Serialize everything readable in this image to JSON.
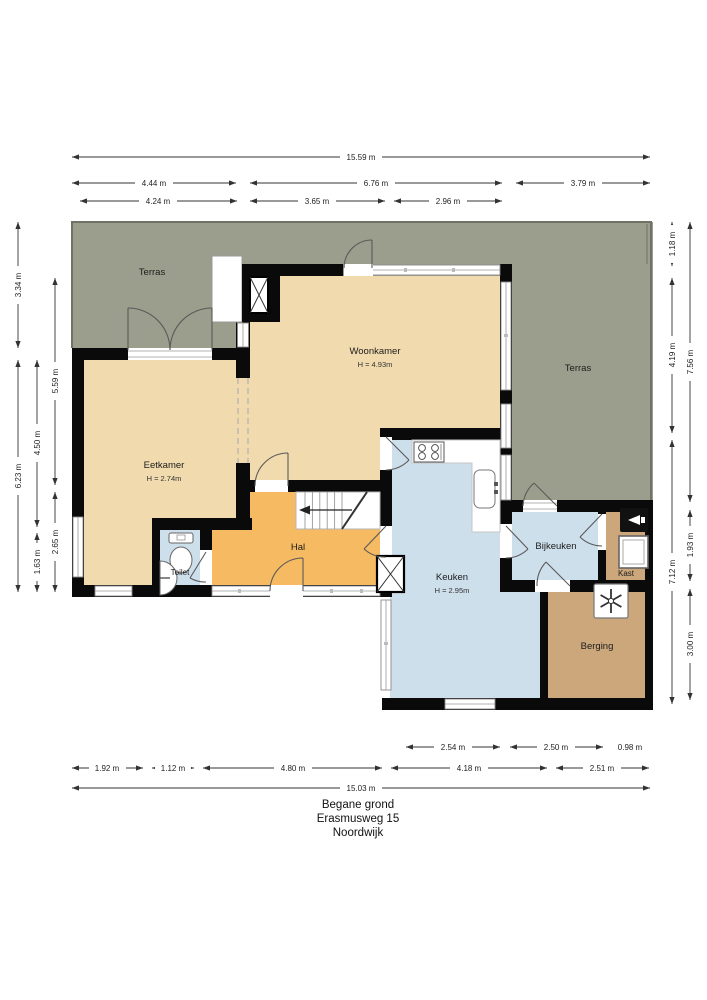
{
  "title": {
    "line1": "Begane grond",
    "line2": "Erasmusweg 15",
    "line3": "Noordwijk"
  },
  "rooms": {
    "terras_left": {
      "label": "Terras"
    },
    "terras_right": {
      "label": "Terras"
    },
    "woonkamer": {
      "label": "Woonkamer",
      "height": "H = 4.93m"
    },
    "eetkamer": {
      "label": "Eetkamer",
      "height": "H = 2.74m"
    },
    "hal": {
      "label": "Hal"
    },
    "toilet": {
      "label": "Toilet"
    },
    "keuken": {
      "label": "Keuken",
      "height": "H = 2.95m"
    },
    "bijkeuken": {
      "label": "Bijkeuken"
    },
    "kast": {
      "label": "Kast"
    },
    "berging": {
      "label": "Berging"
    }
  },
  "dims": {
    "top": [
      {
        "label": "15.59 m"
      },
      {
        "label": "4.44 m"
      },
      {
        "label": "6.76 m"
      },
      {
        "label": "3.79 m"
      },
      {
        "label": "4.24 m"
      },
      {
        "label": "3.65 m"
      },
      {
        "label": "2.96 m"
      }
    ],
    "left": [
      {
        "label": "3.34 m"
      },
      {
        "label": "6.23 m"
      },
      {
        "label": "4.50 m"
      },
      {
        "label": "1.63 m"
      },
      {
        "label": "5.59 m"
      },
      {
        "label": "2.65 m"
      }
    ],
    "right": [
      {
        "label": "1.18 m"
      },
      {
        "label": "4.19 m"
      },
      {
        "label": "7.12 m"
      },
      {
        "label": "7.56 m"
      },
      {
        "label": "1.93 m"
      },
      {
        "label": "3.00 m"
      }
    ],
    "bottom": [
      {
        "label": "2.54 m"
      },
      {
        "label": "2.50 m"
      },
      {
        "label": "0.98 m"
      },
      {
        "label": "1.92 m"
      },
      {
        "label": "1.12 m"
      },
      {
        "label": "4.80 m"
      },
      {
        "label": "4.18 m"
      },
      {
        "label": "2.51 m"
      },
      {
        "label": "15.03 m"
      }
    ]
  },
  "colors": {
    "terrace": "#9b9e8c",
    "living": "#f1dbae",
    "hall": "#f5ba62",
    "wet_rooms": "#cedfec",
    "storage": "#cba77b",
    "wall": "#0a0a0a"
  },
  "icons": {
    "stairs_direction": "left-arrow",
    "gas_hob": "4-burner-grid",
    "sink": "rounded-basin",
    "toilet": "cistern-and-bowl",
    "hand_basin": "half-round-basin",
    "meter": "black-box-arrow",
    "boiler": "white-square",
    "ventilation_fan": "6-spoke-rosette",
    "duct": "x-box",
    "chimney": "x-panel"
  }
}
